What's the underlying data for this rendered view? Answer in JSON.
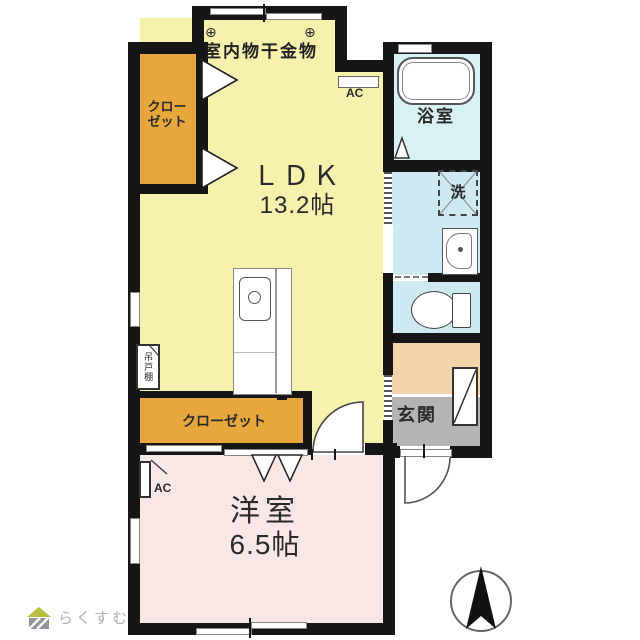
{
  "plan": {
    "labels": {
      "ldk_name": "ＬＤＫ",
      "ldk_size": "13.2帖",
      "western_name": "洋室",
      "western_size": "6.5帖",
      "bathroom": "浴室",
      "entrance": "玄関",
      "closet_upper_line1": "クロー",
      "closet_upper_line2": "ゼット",
      "closet_lower": "クローゼット",
      "laundry": "洗",
      "hanging_cupboard": "吊戸棚",
      "indoor_drying_hardware": "室内物干金物",
      "anchor_symbol": "⊕",
      "ac": "AC"
    },
    "footer": {
      "logo_text": "らくすむ"
    }
  },
  "colors": {
    "wall": "#161616",
    "ldk": "#f6f2ad",
    "closet": "#e8a73d",
    "western": "#f9e7e6",
    "bath": "#d8f1f3",
    "wash": "#cfe9f2",
    "toiletroom": "#cfe9f2",
    "hall": "#f3d3ab",
    "entrance": "#b4b4b6",
    "logo-roof": "#b6bf3e",
    "logo-body": "#8f959b",
    "logo-text": "#b5b0ab"
  }
}
